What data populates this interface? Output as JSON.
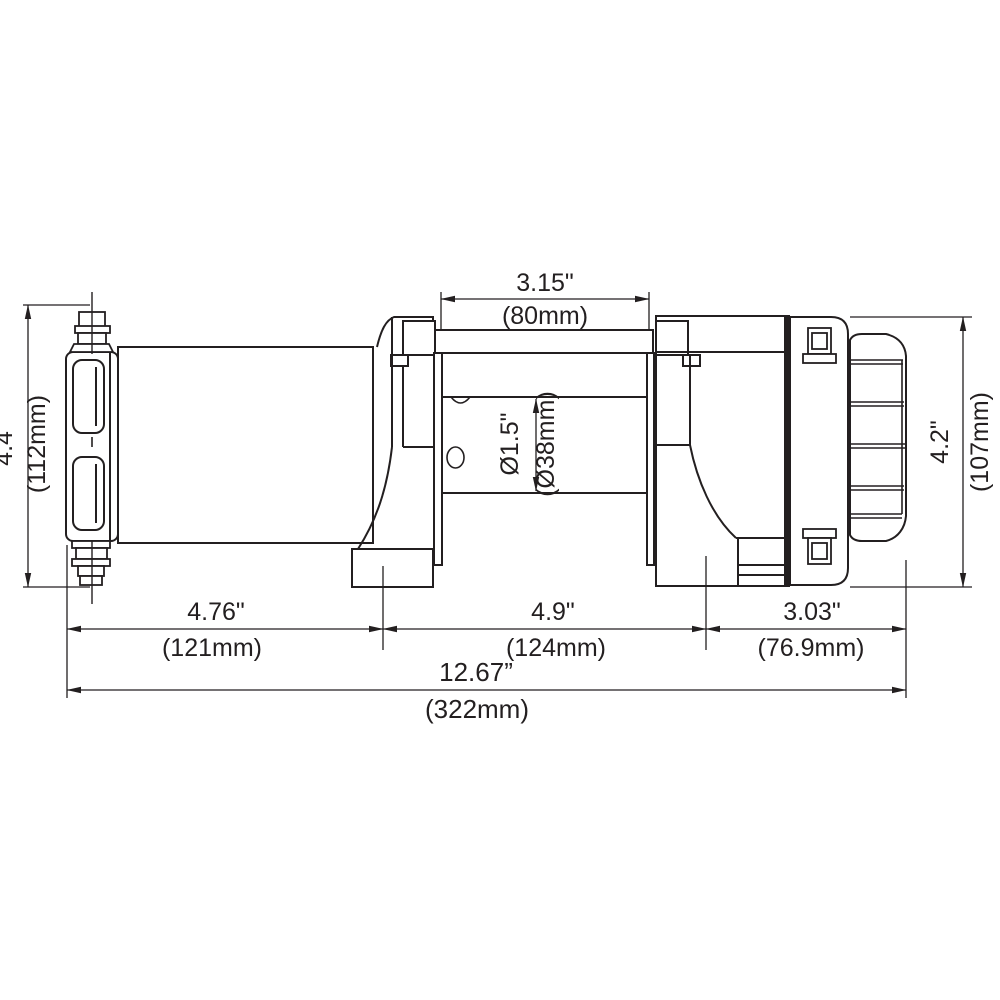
{
  "drawing": {
    "type": "technical-dimension-drawing",
    "subject": "electric winch side view",
    "colors": {
      "line": "#231f20",
      "background": "#ffffff"
    },
    "dims": {
      "top_in": "3.15\"",
      "top_mm": "(80mm)",
      "left_in": "4.4\"",
      "left_mm": "(112mm)",
      "right_in": "4.2\"",
      "right_mm": "(107mm)",
      "drum_in": "Ø1.5\"",
      "drum_mm": "(Ø38mm)",
      "b1_in": "4.76\"",
      "b1_mm": "(121mm)",
      "b2_in": "4.9\"",
      "b2_mm": "(124mm)",
      "b3_in": "3.03\"",
      "b3_mm": "(76.9mm)",
      "overall_in": "12.67”",
      "overall_mm": "(322mm)"
    }
  }
}
